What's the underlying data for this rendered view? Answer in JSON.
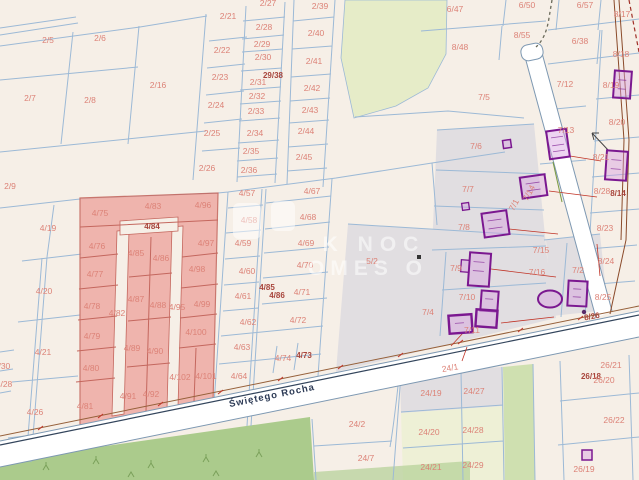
{
  "map": {
    "street": {
      "name": "Świętego Rocha"
    },
    "watermark": {
      "line1": "K NOC",
      "line2": "OMES O"
    },
    "colors": {
      "background": "#f6efe7",
      "parcel_line": "#9cb9d6",
      "parcel_label": "#dc8277",
      "parcel_label_dark": "#a8453c",
      "highlight_fill": "#efada6",
      "highlight_border": "#c4675e",
      "road_fill": "#ffffff",
      "road_edge": "#7d98b2",
      "street_label": "#2c3a55",
      "building_outline": "#7b1890",
      "utility_line": "#8a4a2a",
      "green_area": "#abcb8c",
      "gray_area": "#e1dee1"
    },
    "labels": [
      {
        "t": "2/5",
        "x": 48,
        "y": 40
      },
      {
        "t": "2/6",
        "x": 100,
        "y": 38
      },
      {
        "t": "2/7",
        "x": 30,
        "y": 98
      },
      {
        "t": "2/8",
        "x": 90,
        "y": 100
      },
      {
        "t": "2/16",
        "x": 158,
        "y": 85
      },
      {
        "t": "2/9",
        "x": 10,
        "y": 186
      },
      {
        "t": "2/21",
        "x": 228,
        "y": 16
      },
      {
        "t": "2/22",
        "x": 222,
        "y": 50
      },
      {
        "t": "2/23",
        "x": 220,
        "y": 77
      },
      {
        "t": "2/24",
        "x": 216,
        "y": 105
      },
      {
        "t": "2/25",
        "x": 212,
        "y": 133
      },
      {
        "t": "2/26",
        "x": 207,
        "y": 168
      },
      {
        "t": "2/27",
        "x": 268,
        "y": 3
      },
      {
        "t": "2/28",
        "x": 264,
        "y": 27
      },
      {
        "t": "2/29",
        "x": 262,
        "y": 44
      },
      {
        "t": "2/30",
        "x": 263,
        "y": 57
      },
      {
        "t": "2/31",
        "x": 258,
        "y": 82
      },
      {
        "t": "29/38",
        "x": 273,
        "y": 76,
        "c": "d"
      },
      {
        "t": "2/32",
        "x": 257,
        "y": 96
      },
      {
        "t": "2/33",
        "x": 256,
        "y": 111
      },
      {
        "t": "2/34",
        "x": 255,
        "y": 133
      },
      {
        "t": "2/35",
        "x": 251,
        "y": 151
      },
      {
        "t": "2/36",
        "x": 249,
        "y": 170
      },
      {
        "t": "2/39",
        "x": 320,
        "y": 6
      },
      {
        "t": "2/40",
        "x": 316,
        "y": 33
      },
      {
        "t": "2/41",
        "x": 314,
        "y": 61
      },
      {
        "t": "2/42",
        "x": 312,
        "y": 88
      },
      {
        "t": "2/43",
        "x": 310,
        "y": 110
      },
      {
        "t": "2/44",
        "x": 306,
        "y": 131
      },
      {
        "t": "2/45",
        "x": 304,
        "y": 157
      },
      {
        "t": "4/19",
        "x": 48,
        "y": 228
      },
      {
        "t": "4/20",
        "x": 44,
        "y": 291
      },
      {
        "t": "4/21",
        "x": 43,
        "y": 352
      },
      {
        "t": "4/30",
        "x": 2,
        "y": 366
      },
      {
        "t": "4/28",
        "x": 4,
        "y": 384
      },
      {
        "t": "4/26",
        "x": 35,
        "y": 412
      },
      {
        "t": "4/75",
        "x": 100,
        "y": 213
      },
      {
        "t": "4/83",
        "x": 153,
        "y": 206
      },
      {
        "t": "4/96",
        "x": 203,
        "y": 205
      },
      {
        "t": "4/84",
        "x": 152,
        "y": 227,
        "c": "d"
      },
      {
        "t": "4/76",
        "x": 97,
        "y": 246
      },
      {
        "t": "4/85",
        "x": 136,
        "y": 253
      },
      {
        "t": "4/86",
        "x": 161,
        "y": 258
      },
      {
        "t": "4/97",
        "x": 206,
        "y": 243
      },
      {
        "t": "4/77",
        "x": 95,
        "y": 274
      },
      {
        "t": "4/98",
        "x": 197,
        "y": 269
      },
      {
        "t": "4/78",
        "x": 92,
        "y": 306
      },
      {
        "t": "4/87",
        "x": 136,
        "y": 299
      },
      {
        "t": "4/88",
        "x": 158,
        "y": 305
      },
      {
        "t": "4/82",
        "x": 117,
        "y": 313
      },
      {
        "t": "4/95",
        "x": 177,
        "y": 307
      },
      {
        "t": "4/99",
        "x": 202,
        "y": 304
      },
      {
        "t": "4/79",
        "x": 92,
        "y": 336
      },
      {
        "t": "4/89",
        "x": 132,
        "y": 348
      },
      {
        "t": "4/90",
        "x": 155,
        "y": 351
      },
      {
        "t": "4/100",
        "x": 196,
        "y": 332
      },
      {
        "t": "4/80",
        "x": 91,
        "y": 368
      },
      {
        "t": "4/102",
        "x": 180,
        "y": 377
      },
      {
        "t": "4/101",
        "x": 206,
        "y": 376
      },
      {
        "t": "4/91",
        "x": 128,
        "y": 396
      },
      {
        "t": "4/92",
        "x": 151,
        "y": 394
      },
      {
        "t": "4/81",
        "x": 85,
        "y": 406
      },
      {
        "t": "4/57",
        "x": 247,
        "y": 193
      },
      {
        "t": "4/67",
        "x": 312,
        "y": 191
      },
      {
        "t": "4/58",
        "x": 249,
        "y": 220
      },
      {
        "t": "4/68",
        "x": 308,
        "y": 217
      },
      {
        "t": "4/59",
        "x": 243,
        "y": 243
      },
      {
        "t": "4/69",
        "x": 306,
        "y": 243
      },
      {
        "t": "4/60",
        "x": 247,
        "y": 271
      },
      {
        "t": "4/70",
        "x": 305,
        "y": 265
      },
      {
        "t": "4/61",
        "x": 243,
        "y": 296
      },
      {
        "t": "4/71",
        "x": 302,
        "y": 292
      },
      {
        "t": "4/85",
        "x": 267,
        "y": 288,
        "c": "d"
      },
      {
        "t": "4/86",
        "x": 277,
        "y": 296,
        "c": "d"
      },
      {
        "t": "4/62",
        "x": 248,
        "y": 322
      },
      {
        "t": "4/72",
        "x": 298,
        "y": 320
      },
      {
        "t": "4/63",
        "x": 242,
        "y": 347
      },
      {
        "t": "4/74",
        "x": 283,
        "y": 358
      },
      {
        "t": "4/73",
        "x": 304,
        "y": 356,
        "c": "d"
      },
      {
        "t": "4/64",
        "x": 239,
        "y": 376
      },
      {
        "t": "5/2",
        "x": 372,
        "y": 261
      },
      {
        "t": "6/47",
        "x": 455,
        "y": 9
      },
      {
        "t": "6/50",
        "x": 527,
        "y": 5
      },
      {
        "t": "6/57",
        "x": 585,
        "y": 5
      },
      {
        "t": "8/17",
        "x": 622,
        "y": 14
      },
      {
        "t": "8/48",
        "x": 460,
        "y": 47
      },
      {
        "t": "8/55",
        "x": 522,
        "y": 35
      },
      {
        "t": "6/38",
        "x": 580,
        "y": 41
      },
      {
        "t": "8/18",
        "x": 621,
        "y": 54
      },
      {
        "t": "7/5",
        "x": 484,
        "y": 97
      },
      {
        "t": "7/12",
        "x": 565,
        "y": 84
      },
      {
        "t": "8/19",
        "x": 611,
        "y": 85
      },
      {
        "t": "8/20",
        "x": 617,
        "y": 122
      },
      {
        "t": "7/13",
        "x": 566,
        "y": 130
      },
      {
        "t": "8/21",
        "x": 601,
        "y": 157
      },
      {
        "t": "7/6",
        "x": 476,
        "y": 146
      },
      {
        "t": "7/7",
        "x": 468,
        "y": 189
      },
      {
        "t": "7/8",
        "x": 464,
        "y": 227
      },
      {
        "t": "8/28",
        "x": 602,
        "y": 191
      },
      {
        "t": "8/14",
        "x": 618,
        "y": 194,
        "c": "d"
      },
      {
        "t": "8/23",
        "x": 605,
        "y": 228
      },
      {
        "t": "7/14",
        "x": 529,
        "y": 193,
        "r": -62
      },
      {
        "t": "7/1",
        "x": 514,
        "y": 205,
        "r": -62
      },
      {
        "t": "7/15",
        "x": 541,
        "y": 250
      },
      {
        "t": "7/16",
        "x": 537,
        "y": 272
      },
      {
        "t": "7/2",
        "x": 578,
        "y": 270
      },
      {
        "t": "8/24",
        "x": 606,
        "y": 261
      },
      {
        "t": "8/25",
        "x": 603,
        "y": 297
      },
      {
        "t": "7/9",
        "x": 456,
        "y": 268
      },
      {
        "t": "7/10",
        "x": 467,
        "y": 297
      },
      {
        "t": "7/11",
        "x": 472,
        "y": 330
      },
      {
        "t": "7/4",
        "x": 428,
        "y": 312
      },
      {
        "t": "8/26",
        "x": 592,
        "y": 317,
        "c": "d",
        "r": -10
      },
      {
        "t": "24/1",
        "x": 450,
        "y": 368,
        "r": -10
      },
      {
        "t": "24/19",
        "x": 431,
        "y": 393
      },
      {
        "t": "24/27",
        "x": 474,
        "y": 391
      },
      {
        "t": "24/2",
        "x": 357,
        "y": 424
      },
      {
        "t": "24/20",
        "x": 429,
        "y": 432
      },
      {
        "t": "24/28",
        "x": 473,
        "y": 430
      },
      {
        "t": "24/7",
        "x": 366,
        "y": 458
      },
      {
        "t": "24/21",
        "x": 431,
        "y": 467
      },
      {
        "t": "24/29",
        "x": 473,
        "y": 465
      },
      {
        "t": "26/21",
        "x": 611,
        "y": 365
      },
      {
        "t": "26/18",
        "x": 591,
        "y": 377,
        "c": "d"
      },
      {
        "t": "26/20",
        "x": 604,
        "y": 380
      },
      {
        "t": "26/22",
        "x": 614,
        "y": 420
      },
      {
        "t": "26/19",
        "x": 584,
        "y": 469
      }
    ]
  }
}
